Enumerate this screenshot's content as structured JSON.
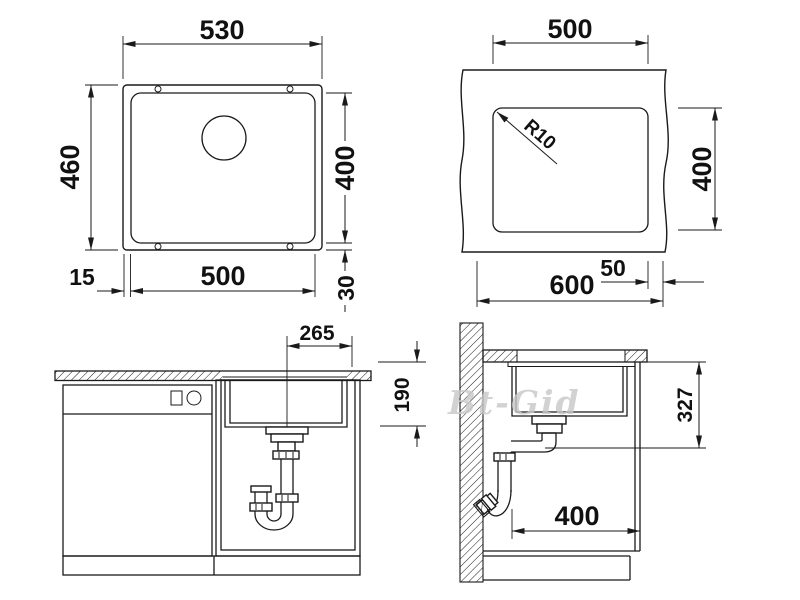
{
  "watermark": "Bt-Gid",
  "views": {
    "sink_top": {
      "dims": {
        "outer_width": "530",
        "outer_height": "460",
        "inner_width": "500",
        "inner_height": "400",
        "rim_left": "15",
        "rim_bottom": "30"
      }
    },
    "cutout_plan": {
      "dims": {
        "cutout_width": "500",
        "cutout_height": "400",
        "corner_radius": "R10",
        "counter_width": "600",
        "edge_offset": "50"
      }
    },
    "cabinet_front": {
      "dims": {
        "drain_offset": "265",
        "bowl_depth": "190"
      }
    },
    "cabinet_side": {
      "dims": {
        "drain_height": "327",
        "min_cabinet_width": "400"
      }
    }
  }
}
